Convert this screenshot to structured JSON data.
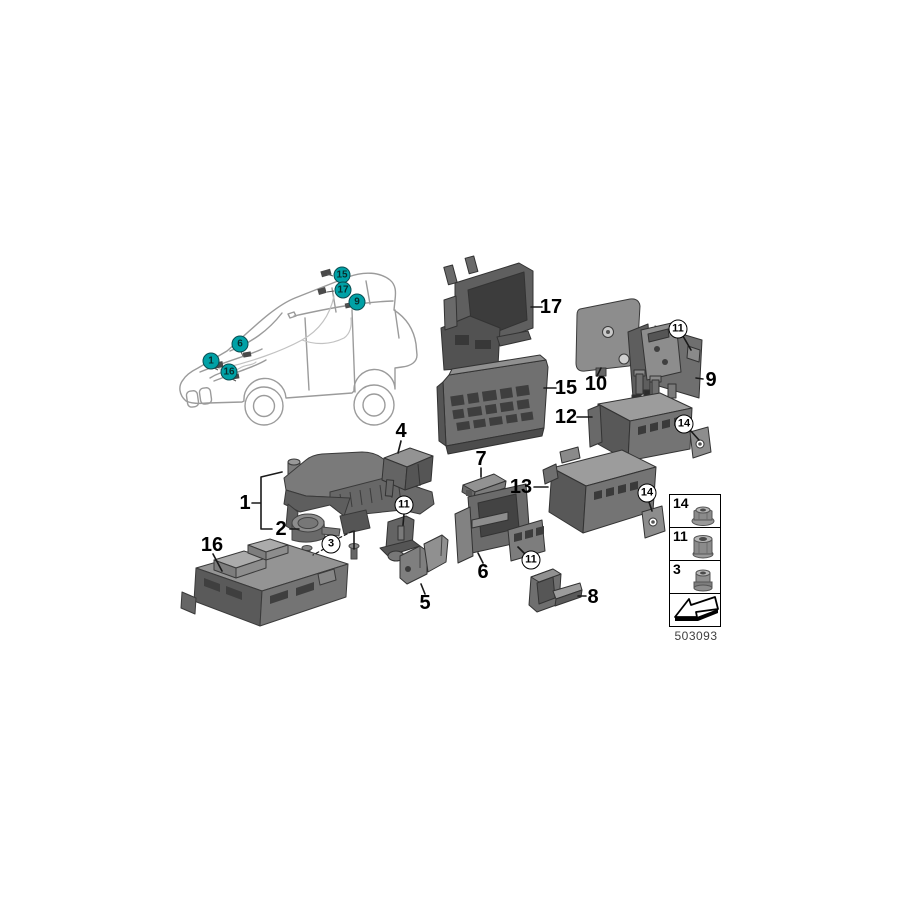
{
  "colors": {
    "callout_fill": "#00a1a6",
    "callout_border": "#0b4c50",
    "line_color": "#1a1a1a",
    "part_gray": "#6e6e6e"
  },
  "car_callouts": [
    {
      "label": "15"
    },
    {
      "label": "17"
    },
    {
      "label": "9"
    },
    {
      "label": "6"
    },
    {
      "label": "1"
    },
    {
      "label": "16"
    }
  ],
  "part_labels": [
    {
      "label": "17"
    },
    {
      "label": "15"
    },
    {
      "label": "10"
    },
    {
      "label": "9"
    },
    {
      "label": "12"
    },
    {
      "label": "13"
    },
    {
      "label": "1"
    },
    {
      "label": "2"
    },
    {
      "label": "16"
    },
    {
      "label": "4"
    },
    {
      "label": "7"
    },
    {
      "label": "5"
    },
    {
      "label": "6"
    },
    {
      "label": "8"
    }
  ],
  "circle_callouts": [
    {
      "label": "11"
    },
    {
      "label": "14"
    },
    {
      "label": "14"
    },
    {
      "label": "11"
    },
    {
      "label": "3"
    },
    {
      "label": "11"
    }
  ],
  "legend": {
    "items": [
      {
        "label": "14",
        "icon": "flange-nut"
      },
      {
        "label": "11",
        "icon": "hex-nut"
      },
      {
        "label": "3",
        "icon": "bushing-nut"
      },
      {
        "label": "",
        "icon": "direction-arrow"
      }
    ],
    "code": "503093"
  }
}
